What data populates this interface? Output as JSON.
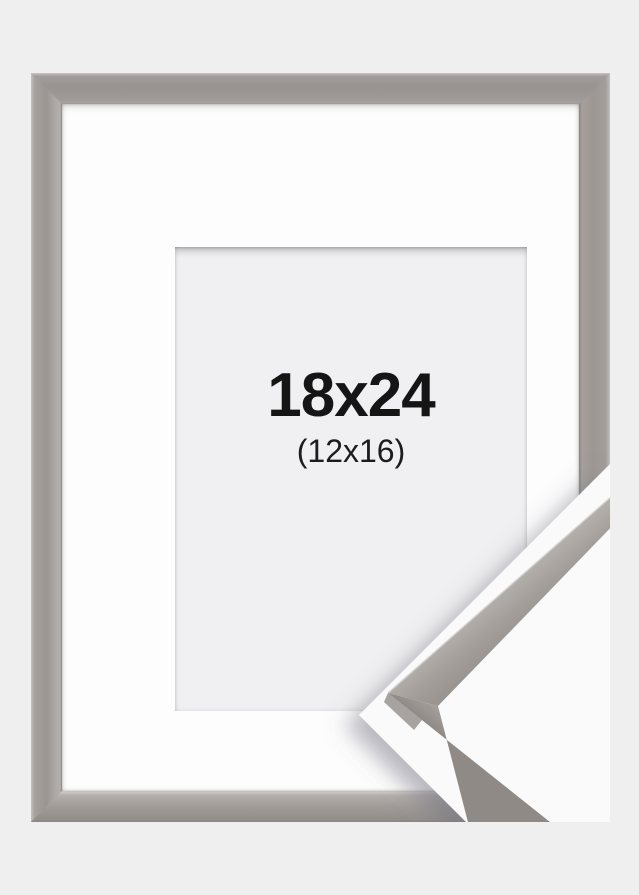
{
  "product": {
    "size_label": "18x24",
    "mat_size_label": "(12x16)",
    "description": "grey picture frame with white mat and corner detail sample",
    "colors": {
      "page_background": "#efeff0",
      "frame_face": "#9e9995",
      "frame_edge_light": "#c9c6c4",
      "frame_edge_dark": "#8d8985",
      "mat_white": "#fdfdfd",
      "opening_fill": "#f0f0f2",
      "label_text": "#151515",
      "detail_background": "#fafafb",
      "sample_face": "#a6a09c",
      "sample_highlight": "#cdc9c6",
      "sample_outer_edge": "#8f8a85"
    }
  }
}
